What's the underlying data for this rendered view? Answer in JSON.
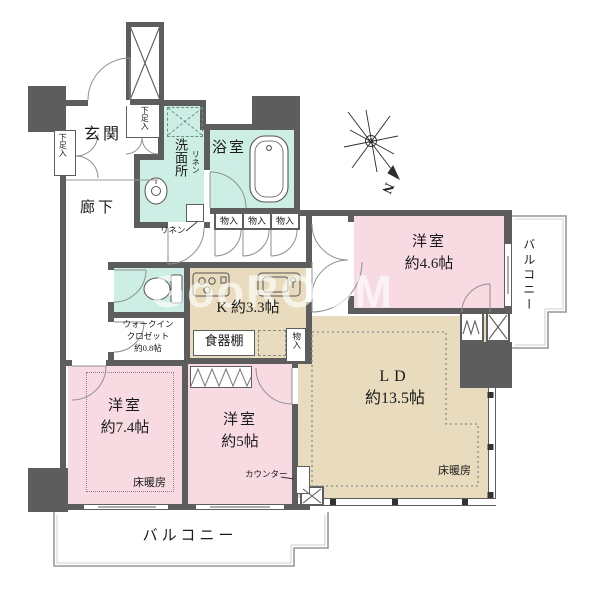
{
  "floorplan": {
    "watermark": "GooROOM",
    "compass": {
      "north": "N"
    },
    "entry": {
      "genkan": "玄関",
      "corridor": "廊下",
      "shoe_top": "下足入",
      "shoe_left": "下足入"
    },
    "wet": {
      "washroom": "洗面所",
      "bath": "浴室",
      "linen_cabinet": "リネン",
      "linen_note": "リネン"
    },
    "storage": {
      "monoire_1": "物入",
      "monoire_2": "物入",
      "monoire_3": "物入",
      "monoire_kitchen": "物入",
      "wic_line1": "ウォークイン",
      "wic_line2": "クロゼット",
      "wic_line3": "約0.8帖",
      "cupboard": "食器棚"
    },
    "kitchen": {
      "label": "K 約3.3帖"
    },
    "rooms": {
      "bedroom46_name": "洋室",
      "bedroom46_size": "約4.6帖",
      "bedroom74_name": "洋室",
      "bedroom74_size": "約7.4帖",
      "bedroom5_name": "洋室",
      "bedroom5_size": "約5帖",
      "ld_name": "LD",
      "ld_size": "約13.5帖",
      "counter": "カウンター",
      "floor_heating_74": "床暖房",
      "floor_heating_ld": "床暖房"
    },
    "balconies": {
      "right": "バルコニー",
      "bottom": "バルコニー"
    },
    "colors": {
      "wall": "#5d5d5d",
      "pink": "#f8dbe2",
      "beige": "#e9dcbe",
      "aqua": "#cceee5"
    }
  }
}
